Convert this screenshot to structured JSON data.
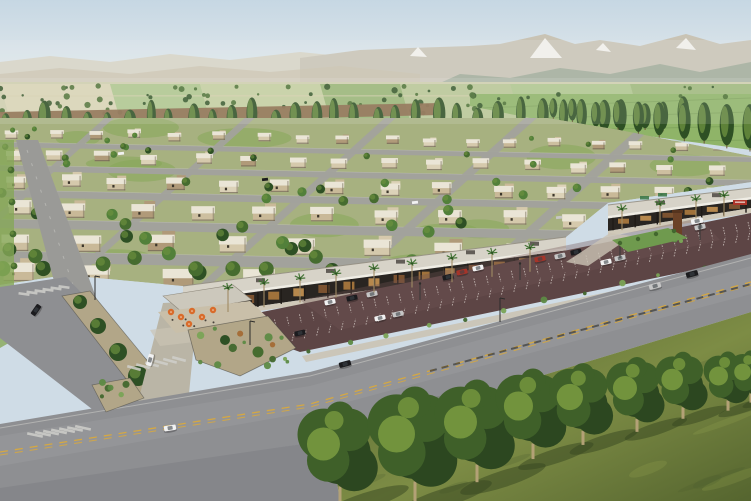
{
  "scene": {
    "type": "architectural-aerial-rendering",
    "subject": "Aerial rendering of a master-planned residential community with a retail strip center, parking lot, landscaped boulevard, tree rows and a mountain backdrop",
    "canvas": {
      "width": 751,
      "height": 501
    },
    "palette": {
      "sky_top": "#c6d7e3",
      "sky_horizon": "#e9edee",
      "mountain_haze": "#d6d0c1",
      "mountain_far": "#c9c3b4",
      "mountain_tan": "#c9bfa8",
      "foothill": "#9ba795",
      "snow": "#f6f5f1",
      "valley_base": "#cfceae",
      "field_greens": [
        "#a9c489",
        "#8fb06c",
        "#dbd5b6",
        "#c2cf9d",
        "#96b573",
        "#b5c490"
      ],
      "dirt": "#8a6b4b",
      "pasture": "#8fb468",
      "fence": "#6f9550",
      "tree_dark": "#2e5024",
      "tree_mid": "#466c2f",
      "tree_light": "#6f9340",
      "trunk": "#6b5636",
      "res_base": "#a7b180",
      "lawn": "#86a858",
      "street": "#a2a29c",
      "curb": "#cacac4",
      "house_walls": [
        "#dcd2b8",
        "#d5c9ac",
        "#cdbfa0",
        "#c9b998",
        "#b09a79"
      ],
      "house_roof": "#eae5d6",
      "house_shade": "#6f6553",
      "house_window": "#3c362b",
      "strip_roof": "#d7d3c8",
      "strip_fascia": "#f0ede4",
      "strip_edge": "#8f897c",
      "storefront": "#292521",
      "column": "#1f1b17",
      "window_glow": [
        "#b5803f",
        "#cf9a55",
        "#8a5a33"
      ],
      "walk": "#cfc7b4",
      "palm_trunk": "#a08b64",
      "palm_frond": "#3e7030",
      "monument": "#6b4227",
      "sign_red": "#ae352a",
      "sign_green": "#3e7a4a",
      "lot": "#5d4545",
      "lot_light": "#705353",
      "stripe": "#ccc2bd",
      "road": "#8e8f92",
      "road_dark": "#85868a",
      "road_light": "#b9babc",
      "lane_yellow": "#d8a93e",
      "lane_white": "#cfcfca",
      "median_dark": "#3a3a38",
      "sidewalk": "#cac3b4",
      "island_gravel": "#b2a688",
      "shrub_greens": [
        "#5d8a45",
        "#7aa356",
        "#42672e"
      ],
      "shrub_rust": "#a46a35",
      "grass_light": "#7d8c45",
      "grass_dark": "#55652f",
      "grass_streak": "#9aa754",
      "grass_shadow": "#36461f",
      "fg_tree_dark": "#2c4720",
      "fg_tree_mid": "#3f6029",
      "fg_tree_light": "#78993f",
      "fg_trunk": "#b3a176",
      "car_colors": {
        "w": "#f2f2f2",
        "k": "#1b1b1e",
        "s": "#c6c6c6",
        "r": "#a63429"
      },
      "cabin": "#3c4248"
    },
    "mountains": {
      "haze_poly": "0,62 50,56 110,62 170,54 230,60 300,52 360,58 420,52 470,58 470,92 0,92",
      "far_poly": "300,58 360,50 410,48 470,46 500,44 545,34 575,44 600,40 640,46 686,34 720,44 751,40 751,92 300,92",
      "tan_poly": "0,74 60,68 130,74 200,66 270,72 340,66 420,74 420,92 0,92",
      "foothill_poly": "420,92 460,74 510,78 560,68 610,74 660,64 700,72 751,62 751,92",
      "snow": [
        "530,58 545,38 562,58",
        "676,48 686,38 696,50",
        "410,56 418,47 427,57",
        "596,50 603,43 611,52"
      ]
    },
    "farmland": {
      "strips": [
        {
          "x": 0,
          "w": 110,
          "f": 2
        },
        {
          "x": 110,
          "w": 90,
          "f": 0
        },
        {
          "x": 200,
          "w": 120,
          "f": 3
        },
        {
          "x": 320,
          "w": 80,
          "f": 1
        },
        {
          "x": 400,
          "w": 110,
          "f": 5
        },
        {
          "x": 510,
          "w": 120,
          "f": 0
        },
        {
          "x": 630,
          "w": 121,
          "f": 4
        }
      ],
      "scatter_count": 85,
      "dirt_poly": "0,112 440,103 440,115 0,125",
      "pasture_poly": "470,94 751,94 751,150 560,124 470,106"
    },
    "poplar_row": {
      "count": 34,
      "x_start": 6,
      "x_step": 20.6,
      "base_y": 137,
      "tilt": -0.008
    },
    "poplar_diag": {
      "count": 10,
      "from": [
        552,
        120
      ],
      "to": [
        748,
        152
      ]
    },
    "residential": {
      "clip": "0,118 548,118 620,130 751,156 751,182 608,203 566,237 183,286 66,275 0,285",
      "row_slope": 0.02,
      "rows": [
        {
          "y": 136,
          "n": 18,
          "sp": 42,
          "w": 12,
          "h": 7
        },
        {
          "y": 158,
          "n": 16,
          "sp": 47,
          "w": 15,
          "h": 9
        },
        {
          "y": 182,
          "n": 14,
          "sp": 54,
          "w": 18,
          "h": 11
        },
        {
          "y": 209,
          "n": 12,
          "sp": 62,
          "w": 22,
          "h": 13
        },
        {
          "y": 240,
          "n": 10,
          "sp": 72,
          "w": 26,
          "h": 15
        },
        {
          "y": 272,
          "n": 9,
          "sp": 80,
          "w": 30,
          "h": 17
        }
      ],
      "streets": [
        {
          "y": 148,
          "w": 5
        },
        {
          "y": 171,
          "w": 6
        },
        {
          "y": 196,
          "w": 7
        },
        {
          "y": 225,
          "w": 9
        },
        {
          "y": 257,
          "w": 11
        }
      ],
      "cross_streets": [
        {
          "x": 110,
          "w": 6
        },
        {
          "x": 250,
          "w": 7
        },
        {
          "x": 390,
          "w": 8
        },
        {
          "x": 530,
          "w": 9
        },
        {
          "x": 655,
          "w": 10
        }
      ],
      "tree_count": 78,
      "lawn_patches": 14,
      "street_cars": [
        [
          118,
          152,
          "w"
        ],
        [
          262,
          178,
          "k"
        ],
        [
          412,
          201,
          "w"
        ],
        [
          556,
          216,
          "s"
        ]
      ]
    },
    "retail_strip": {
      "segment_a": {
        "fascia_from": [
          183,
          299
        ],
        "fascia_to": [
          566,
          248
        ],
        "roof_rise": 13,
        "front_drop": 16,
        "columns": 17,
        "windows": 15,
        "roof_units": [
          260,
          330,
          400,
          470,
          534
        ]
      },
      "segment_b": {
        "fascia_from": [
          608,
          216
        ],
        "fascia_to": [
          751,
          197
        ],
        "roof_rise": 11,
        "front_drop": 13,
        "columns": 7,
        "windows": 6,
        "roof_units": [
          660,
          716
        ]
      },
      "pavilion_poly": "163,296 233,285 252,300 182,312",
      "patio_poly": "158,312 250,301 268,318 176,333",
      "plaza_poly": "150,330 250,318 262,334 160,346",
      "umbrellas": [
        [
          171,
          312
        ],
        [
          181,
          317
        ],
        [
          192,
          311
        ],
        [
          202,
          317
        ],
        [
          213,
          310
        ],
        [
          189,
          324
        ]
      ],
      "palms_a": [
        228,
        264,
        300,
        336,
        374,
        412,
        452,
        492,
        530
      ],
      "palms_b": [
        622,
        660,
        696,
        724
      ],
      "monument": [
        673,
        212
      ],
      "red_sign": [
        733,
        200
      ],
      "green_signs": [
        [
          640,
          196
        ],
        [
          658,
          193
        ]
      ],
      "entry_walk_poly": "566,262 610,233 632,236 588,266",
      "entry_median_poly": "612,240 668,228 688,238 628,252"
    },
    "parking_lot": {
      "poly": "252,314 751,213 751,258 300,352 262,338",
      "light_poly": "300,300 700,218 720,240 340,330",
      "row_a": {
        "from": [
          262,
          322
        ],
        "to": [
          748,
          222
        ],
        "ticks": 40,
        "len": 8.5,
        "dir": 1
      },
      "row_b": {
        "from": [
          292,
          341
        ],
        "to": [
          748,
          240
        ],
        "ticks": 38,
        "len": 8.5,
        "dir": -1
      },
      "cars": [
        [
          330,
          302,
          "w"
        ],
        [
          352,
          298,
          "k"
        ],
        [
          372,
          294,
          "s"
        ],
        [
          448,
          277,
          "k"
        ],
        [
          462,
          272,
          "r"
        ],
        [
          478,
          268,
          "w"
        ],
        [
          540,
          259,
          "r"
        ],
        [
          560,
          256,
          "s"
        ],
        [
          576,
          252,
          "k"
        ],
        [
          640,
          240,
          "w"
        ],
        [
          658,
          236,
          "k"
        ],
        [
          700,
          227,
          "s"
        ],
        [
          380,
          318,
          "w"
        ],
        [
          398,
          314,
          "s"
        ],
        [
          300,
          333,
          "k"
        ],
        [
          606,
          262,
          "w"
        ],
        [
          620,
          258,
          "s"
        ]
      ],
      "poles": [
        [
          420,
          300
        ],
        [
          520,
          280
        ],
        [
          620,
          258
        ],
        [
          700,
          240
        ]
      ]
    },
    "frontage": {
      "walk_poly": "302,356 751,262 751,268 306,362",
      "shrub_count": 12
    },
    "roads": {
      "main_poly": "0,424 310,372 751,254 751,312 330,440 0,490",
      "apron_poly": "0,488 330,440 340,501 0,501",
      "branch_poly": "0,287 66,277 212,426 158,460 0,338",
      "left_poly": "16,140 38,140 108,330 72,348",
      "drive_poly": "138,402 163,303 198,301 188,404",
      "median_poly": "62,296 90,291 168,386 140,397",
      "median_trees": [
        [
          80,
          302,
          7
        ],
        [
          98,
          326,
          8
        ],
        [
          118,
          352,
          9
        ],
        [
          138,
          376,
          10
        ]
      ],
      "big_island_poly": "188,330 268,316 296,348 240,376 196,360",
      "small_island_poly": "92,385 130,378 144,398 106,412",
      "left_lawn_poly": "0,140 14,140 14,340 0,348",
      "left_trees": [
        [
          11,
          170
        ],
        [
          12,
          202
        ],
        [
          13,
          234
        ],
        [
          14,
          266
        ],
        [
          15,
          298
        ]
      ],
      "yellow_line": [
        [
          0,
          452
        ],
        [
          310,
          404
        ],
        [
          751,
          282
        ]
      ],
      "white_edge_top": [
        [
          0,
          428
        ],
        [
          310,
          376
        ],
        [
          751,
          258
        ]
      ],
      "median_dash": [
        [
          430,
          371
        ],
        [
          751,
          284
        ]
      ],
      "street_poles": [
        [
          250,
          345
        ],
        [
          95,
          300
        ],
        [
          500,
          322
        ]
      ],
      "cars": [
        [
          170,
          428,
          -9,
          "w"
        ],
        [
          345,
          364,
          -15,
          "k"
        ],
        [
          655,
          286,
          -15,
          "s"
        ],
        [
          692,
          274,
          -15,
          "k"
        ],
        [
          697,
          221,
          -12,
          "w"
        ],
        [
          36,
          310,
          -55,
          "k"
        ],
        [
          150,
          360,
          -75,
          "w"
        ]
      ],
      "crosswalks": [
        {
          "x": 35,
          "y": 435,
          "n": 7,
          "dx": 8,
          "dy": -1.2,
          "len": 16,
          "rot": -78
        },
        {
          "x": 24,
          "y": 294,
          "n": 6,
          "dx": 8,
          "dy": -1.4,
          "len": 11,
          "rot": -82
        },
        {
          "x": 134,
          "y": 368,
          "n": 6,
          "dx": 9,
          "dy": -1.8,
          "len": 14,
          "rot": -75
        }
      ]
    },
    "foreground": {
      "grass_poly": "330,440 751,312 751,501 340,501",
      "trees": [
        [
          340,
          503,
          118
        ],
        [
          415,
          500,
          132
        ],
        [
          477,
          481,
          118
        ],
        [
          533,
          458,
          104
        ],
        [
          583,
          444,
          94
        ],
        [
          637,
          431,
          86
        ],
        [
          683,
          418,
          77
        ],
        [
          728,
          410,
          68
        ],
        [
          751,
          402,
          60
        ]
      ],
      "streak_count": 14
    }
  }
}
